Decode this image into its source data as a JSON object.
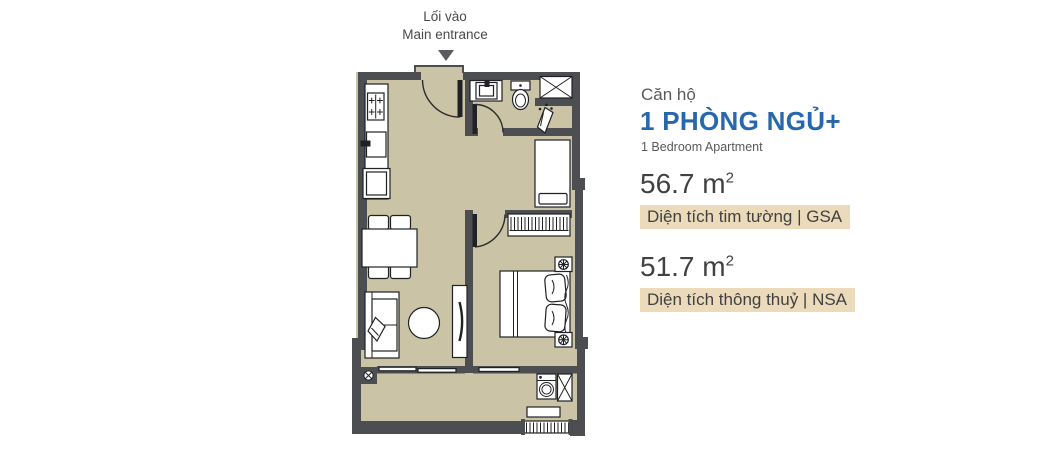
{
  "entrance": {
    "label_vi": "Lối vào",
    "label_en": "Main entrance"
  },
  "info_panel": {
    "unit_type_label": "Căn hộ",
    "unit_type_vi": "1 PHÒNG NGỦ+",
    "unit_type_en": "1 Bedroom Apartment",
    "gsa": {
      "value": "56.7 m",
      "exponent": "2",
      "label": "Diện tích tim tường | GSA"
    },
    "nsa": {
      "value": "51.7 m",
      "exponent": "2",
      "label": "Diện tích thông thuỷ | NSA"
    }
  },
  "colors": {
    "wall": "#4d4e52",
    "floor": "#cac3a6",
    "blue": "#2767ae",
    "tan": "#ebdbba",
    "ink": "#414043",
    "gray": "#58595b",
    "arrow": "#5a5b5f"
  },
  "floor_plan": {
    "rooms": [
      "kitchen",
      "living-dining",
      "bathroom",
      "multipurpose-nook",
      "bedroom",
      "balcony"
    ],
    "icons": [
      "entrance-arrow",
      "entrance-door",
      "cooktop",
      "kitchen-sink",
      "refrigerator",
      "dining-table",
      "dining-chairs",
      "sofa",
      "throw-pillow",
      "coffee-table",
      "tv-console",
      "bathroom-door",
      "bathroom-sink",
      "toilet",
      "shower",
      "ventilation-shaft",
      "single-bed",
      "wardrobe",
      "bedroom-door",
      "double-bed",
      "nightstands",
      "washing-machine",
      "technical-shaft",
      "balcony-shelf",
      "balcony-railing",
      "structural-column",
      "sliding-doors"
    ]
  }
}
